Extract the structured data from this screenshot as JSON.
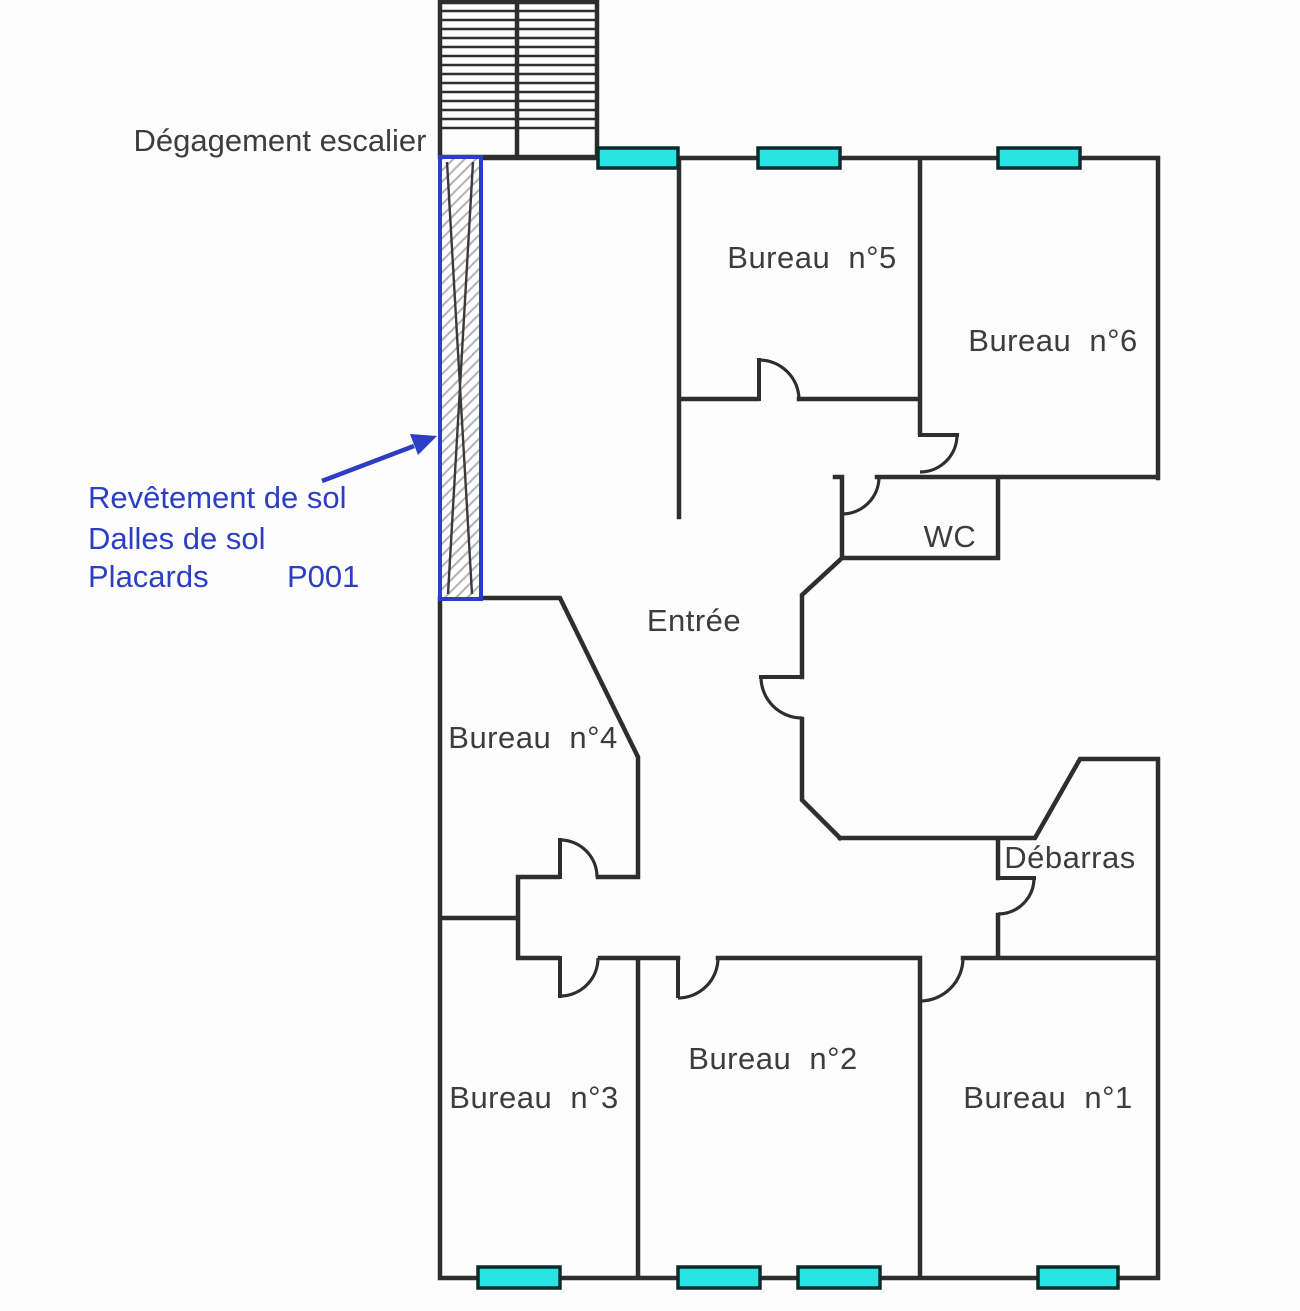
{
  "plan": {
    "labels": {
      "stairwell": "Dégagement escalier",
      "bureau1": "Bureau n°1",
      "bureau2": "Bureau n°2",
      "bureau3": "Bureau n°3",
      "bureau4": "Bureau n°4",
      "bureau5": "Bureau n°5",
      "bureau6": "Bureau n°6",
      "wc": "WC",
      "entree": "Entrée",
      "debarras": "Débarras"
    },
    "annotation": {
      "line1": "Revêtement de sol",
      "line2": "Dalles de sol",
      "line3": "Placards",
      "code": "P001"
    },
    "colors": {
      "wall": "#2e2e2e",
      "label": "#3d3d3d",
      "window_fill": "#29e4e2",
      "window_border": "#0e2b2b",
      "annotation_blue": "#2c3fc4",
      "hatch": "#b4b4b4",
      "background": "#fdfdfd"
    }
  }
}
